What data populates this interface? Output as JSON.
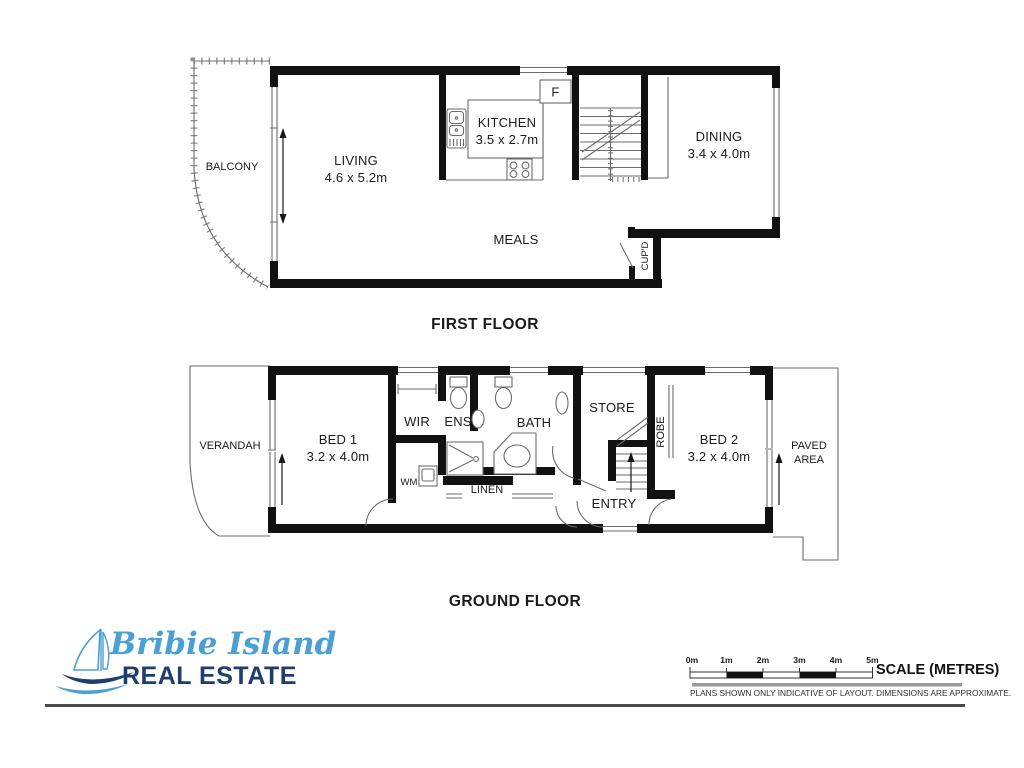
{
  "first_floor": {
    "title": "FIRST FLOOR",
    "balcony": "BALCONY",
    "living": {
      "name": "LIVING",
      "dims": "4.6 x 5.2m"
    },
    "kitchen": {
      "name": "KITCHEN",
      "dims": "3.5 x 2.7m"
    },
    "dining": {
      "name": "DINING",
      "dims": "3.4 x 4.0m"
    },
    "meals": "MEALS",
    "fridge": "F",
    "cupboard": "CUP'D"
  },
  "ground_floor": {
    "title": "GROUND FLOOR",
    "verandah": "VERANDAH",
    "bed1": {
      "name": "BED 1",
      "dims": "3.2 x 4.0m"
    },
    "wir": "WIR",
    "ens": "ENS",
    "bath": "BATH",
    "store": "STORE",
    "robe": "ROBE",
    "bed2": {
      "name": "BED 2",
      "dims": "3.2 x 4.0m"
    },
    "paved1": "PAVED",
    "paved2": "AREA",
    "wm": "WM",
    "linen": "LINEN",
    "entry": "ENTRY"
  },
  "footer": {
    "logo": {
      "script": "Bribie Island",
      "bold": "REAL ESTATE",
      "script_color": "#4a9fd5",
      "bold_color": "#1d3e6f"
    },
    "scale": {
      "ticks": [
        "0m",
        "1m",
        "2m",
        "3m",
        "4m",
        "5m"
      ],
      "title": "SCALE (METRES)",
      "disclaimer": "PLANS SHOWN ONLY INDICATIVE OF LAYOUT.  DIMENSIONS ARE APPROXIMATE."
    }
  }
}
